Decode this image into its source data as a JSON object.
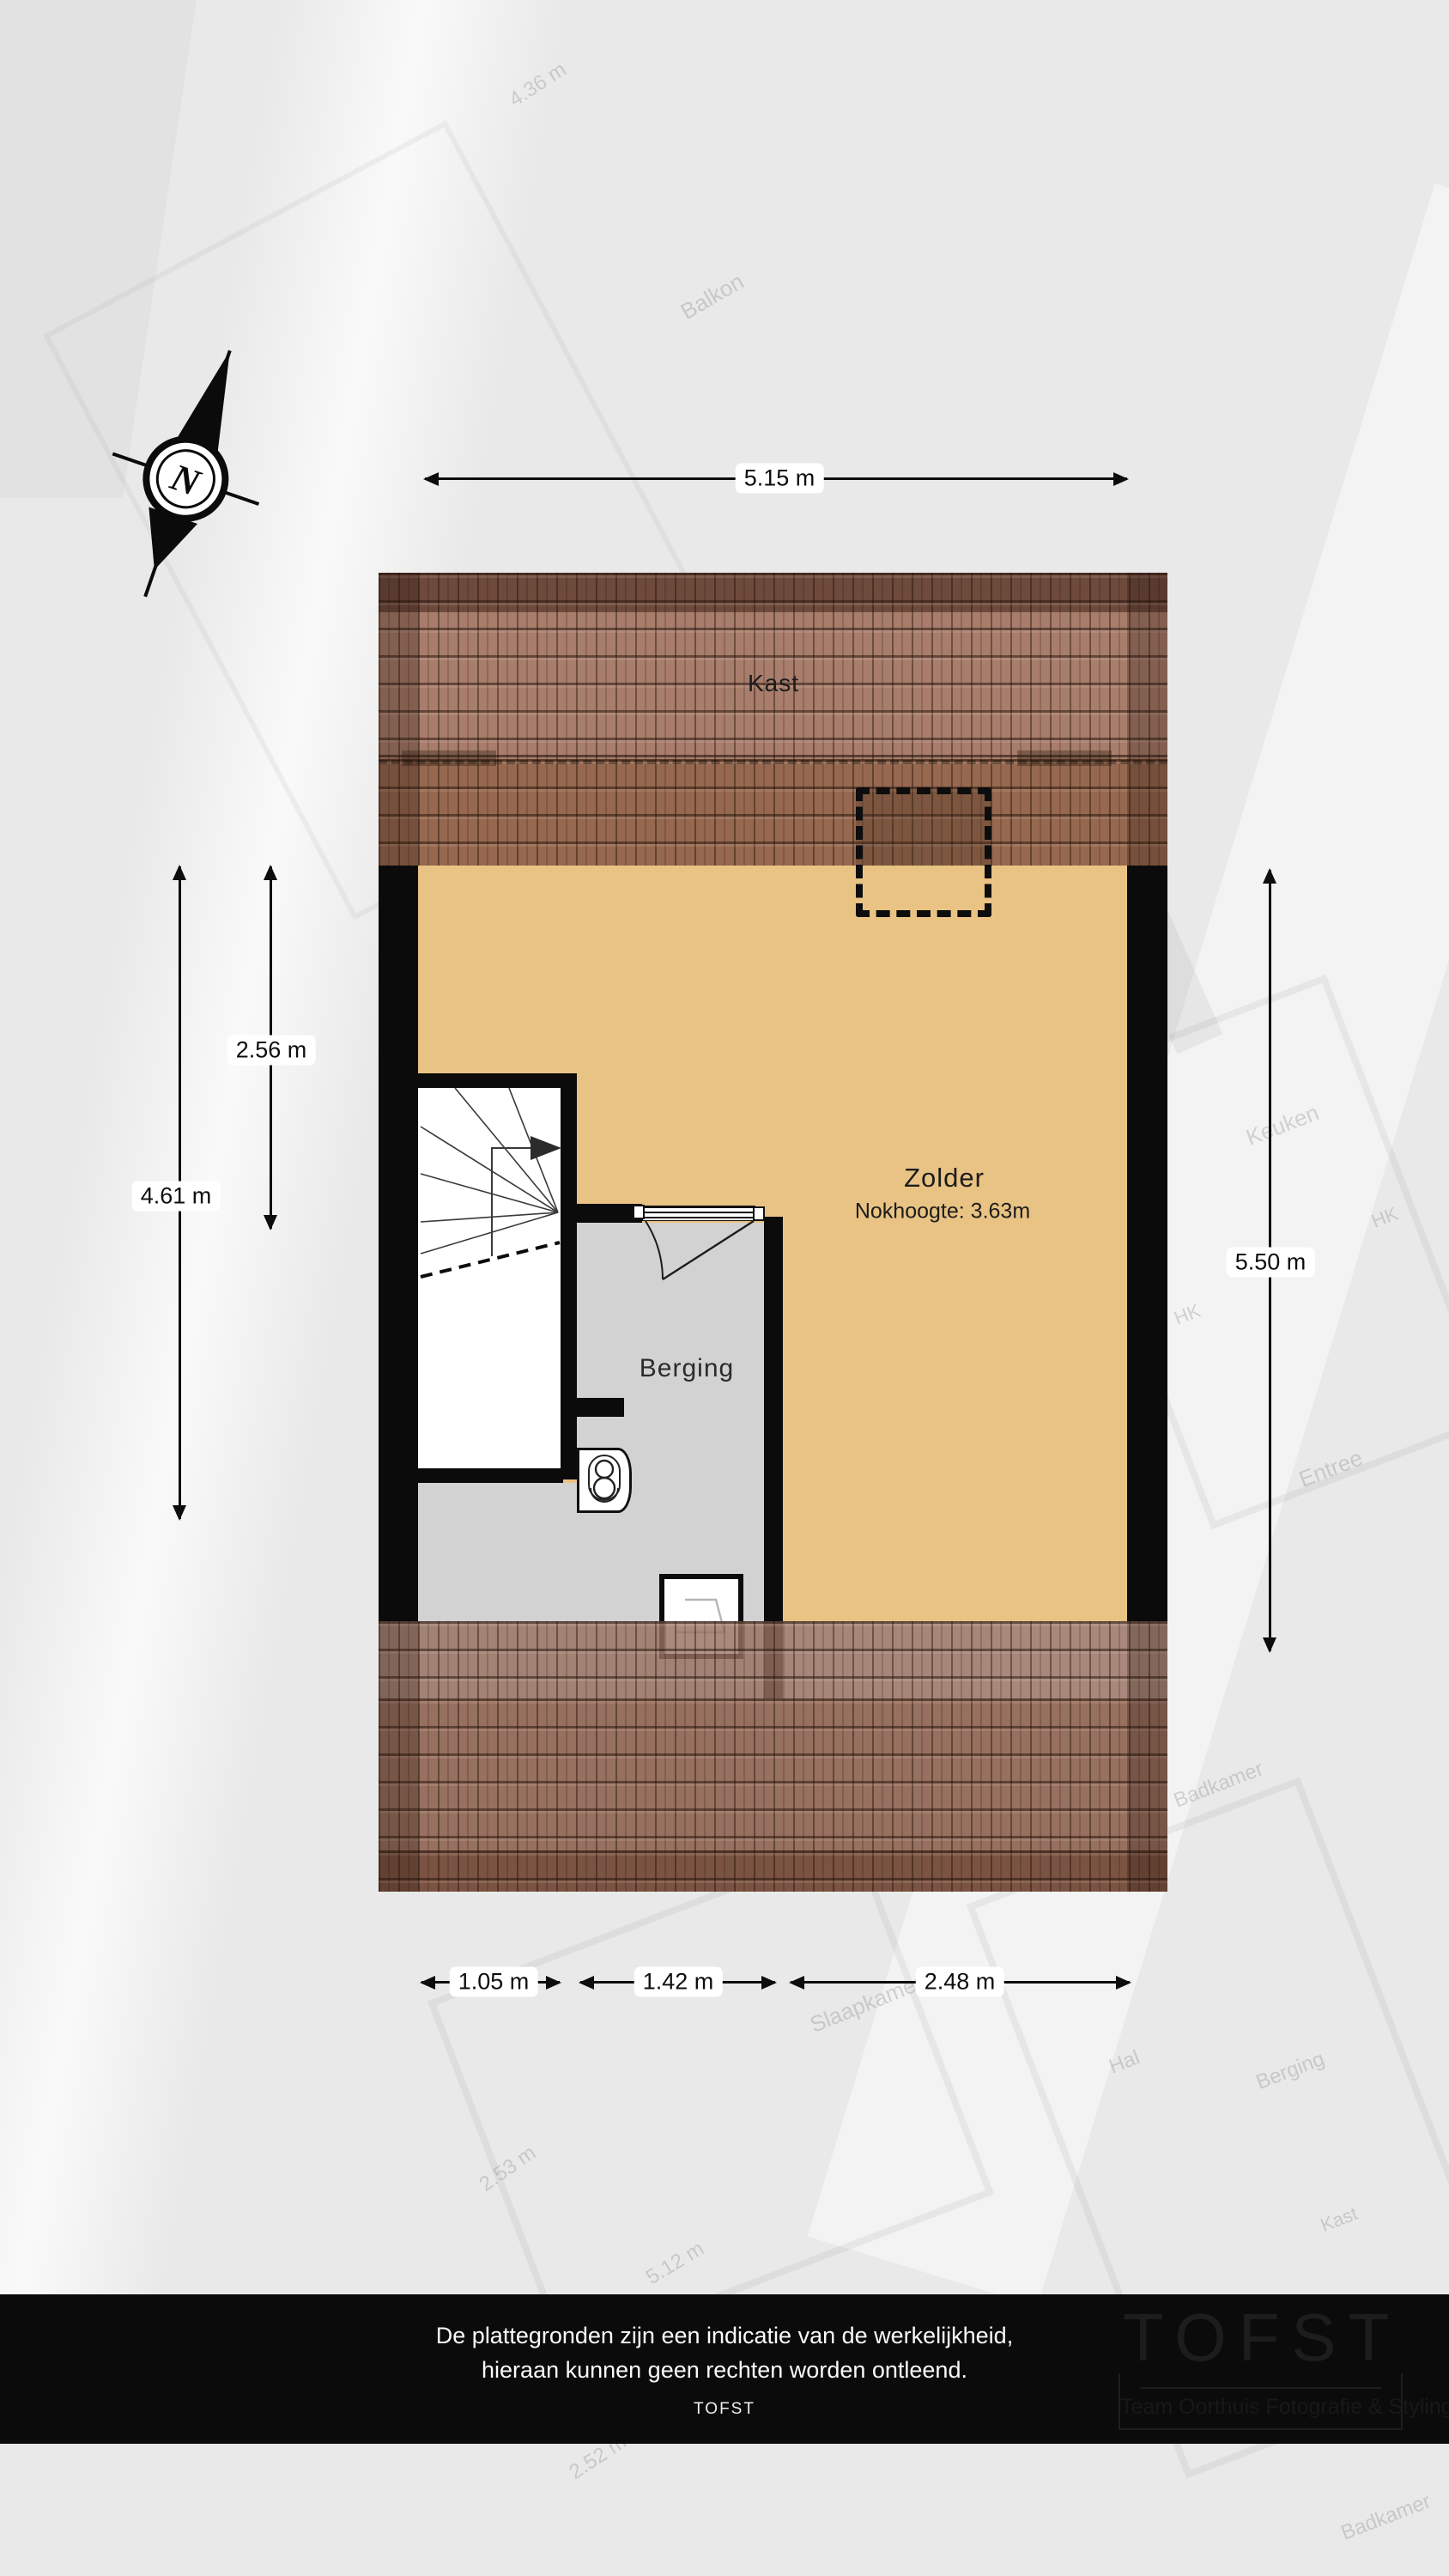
{
  "compass": {
    "label": "N"
  },
  "rooms": {
    "kast": "Kast",
    "zolder": "Zolder",
    "zolder_sub": "Nokhoogte: 3.63m",
    "berging": "Berging"
  },
  "dimensions": {
    "top": {
      "label": "5.15 m"
    },
    "left_outer": {
      "label": "4.61 m"
    },
    "left_inner": {
      "label": "2.56 m"
    },
    "right": {
      "label": "5.50 m"
    },
    "bottom": [
      {
        "label": "1.05 m"
      },
      {
        "label": "1.42 m"
      },
      {
        "label": "2.48 m"
      }
    ]
  },
  "footer": {
    "line1": "De plattegronden zijn een indicatie van de werkelijkheid,",
    "line2": "hieraan kunnen geen rechten worden ontleend.",
    "brand": "TOFST"
  },
  "logo": {
    "title": "TOFST",
    "subtitle": "Team Oorthuis Fotografie & Styling"
  },
  "background_labels": [
    {
      "text": "4.36 m"
    },
    {
      "text": "Balkon"
    },
    {
      "text": "Keuken"
    },
    {
      "text": "HK"
    },
    {
      "text": "HK"
    },
    {
      "text": "Entree"
    },
    {
      "text": "Badkamer"
    },
    {
      "text": "Slaapkamer"
    },
    {
      "text": "Hal"
    },
    {
      "text": "Berging"
    },
    {
      "text": "Kast"
    },
    {
      "text": "2.53 m"
    },
    {
      "text": "5.12 m"
    },
    {
      "text": "2.52 m"
    },
    {
      "text": "Badkamer"
    }
  ],
  "colors": {
    "floor_tan": "#e9c383",
    "floor_gray": "#d2d2d2",
    "wall_black": "#0b0b0b",
    "roof_ridge": "#6e4a3c",
    "roof_upper": "#a87d6b",
    "roof_lower": "#96684f",
    "roof_bottom": "#97705f",
    "roof_eaves": "#7b5342",
    "footer_bg": "#0b0b0b"
  }
}
